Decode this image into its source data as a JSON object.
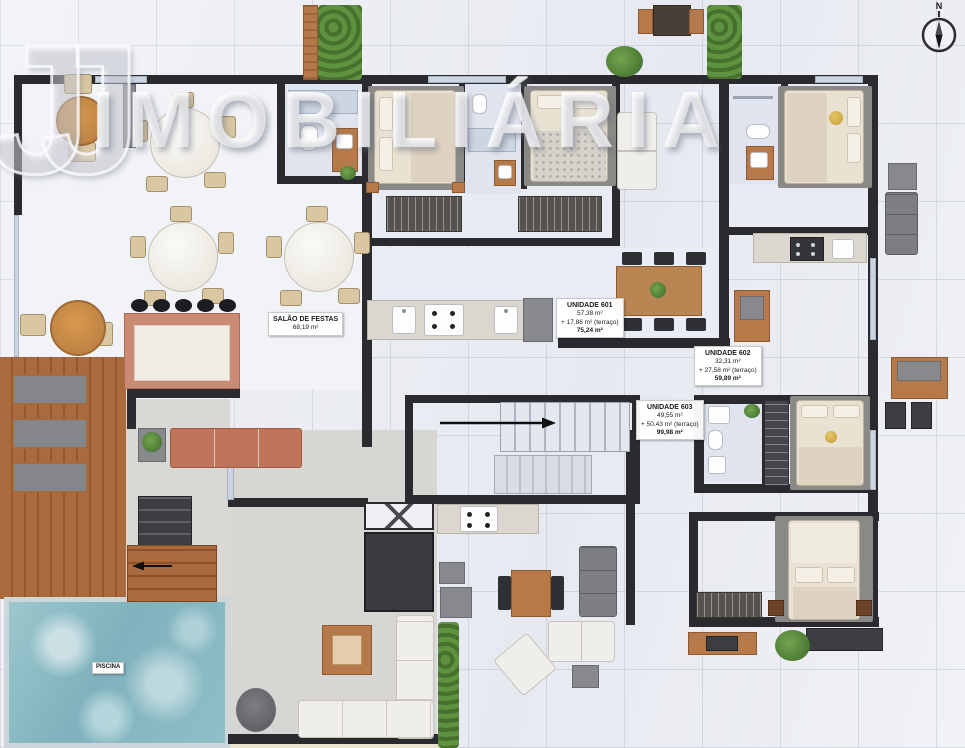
{
  "watermark": {
    "logo_text": "JJ",
    "brand_text": "IMOBILIÁRIA"
  },
  "compass": {
    "north_label": "N"
  },
  "rooms": {
    "salao": {
      "name": "SALÃO DE FESTAS",
      "area": "68,19 m²"
    },
    "piscina": {
      "name": "PISCINA"
    }
  },
  "units": [
    {
      "name": "UNIDADE 601",
      "private_area": "57,38 m²",
      "terrace_area": "+ 17,86 m² (terraço)",
      "total_area": "75,24 m²"
    },
    {
      "name": "UNIDADE 602",
      "private_area": "32,31 m²",
      "terrace_area": "+ 27,58 m² (terraço)",
      "total_area": "59,89 m²"
    },
    {
      "name": "UNIDADE 603",
      "private_area": "49,55 m²",
      "terrace_area": "+ 50,43 m² (terraço)",
      "total_area": "99,98 m²"
    }
  ],
  "colors": {
    "wall": "#2b2b2f",
    "floor_tile": "#edeff4",
    "unit_floor": "#e8ebf3",
    "bath_floor": "#dfe4ee",
    "wood": "#b5794a",
    "deck": "#a3653a",
    "water": "#8fbec8",
    "hedge": "#4f7d38",
    "sofa_terracotta": "#c0745a",
    "label_bg": "#ffffff"
  }
}
